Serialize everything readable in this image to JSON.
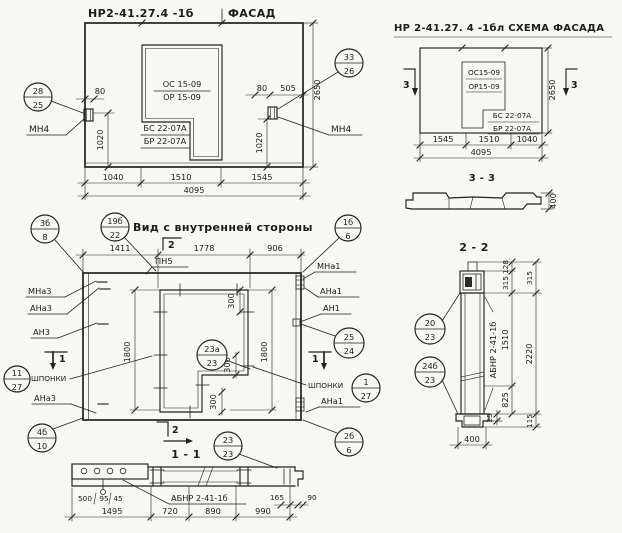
{
  "facade": {
    "code": "НР2-41.27.4 -1б",
    "title": "ФАСАД",
    "os": "ОС 15-09",
    "or": "ОР 15-09",
    "bs": "БС 22-07А",
    "br": "БР 22-07А",
    "mn4_left": "МН4",
    "mn4_right": "МН4",
    "co_left": {
      "top": "28",
      "bot": "25"
    },
    "co_right": {
      "top": "33",
      "bot": "26"
    },
    "d80l": "80",
    "d80r": "80",
    "d505": "505",
    "v1020l": "1020",
    "v1020r": "1020",
    "v2650": "2650",
    "b1": "1040",
    "b2": "1510",
    "b3": "1545",
    "btotal": "4095"
  },
  "schema": {
    "title": "НР 2-41.27. 4 -1бл СХЕМА ФАСАДА",
    "mark_left": "3",
    "mark_right": "3",
    "os": "ОС15-09",
    "or": "ОР15-09",
    "bs": "БС 22-07А",
    "br": "БР 22-07А",
    "v2650": "2650",
    "b1": "1545",
    "b2": "1510",
    "b3": "1040",
    "btotal": "4095"
  },
  "s33": {
    "title": "3 - 3",
    "d400": "400"
  },
  "view": {
    "title": "Вид с внутренней стороны",
    "pn5": "ПН5",
    "t1": "1411",
    "t2": "1778",
    "t3": "906",
    "mark_top": "2",
    "mark_bottom": "2",
    "mark_left": "1",
    "mark_right": "1",
    "v1800l": "1800",
    "v1800r": "1800",
    "d300a": "300",
    "d300b": "300",
    "d300c": "300",
    "mna3": "МНа3",
    "ana3": "АНа3",
    "an3": "АН3",
    "shponki_l": "ШПОНКИ",
    "ana3b": "АНа3",
    "mna1": "МНа1",
    "ana1": "АНа1",
    "an1": "АН1",
    "shponki_r": "ШПОНКИ",
    "ana1b": "АНа1",
    "co_title": {
      "top": "19б",
      "bot": "22"
    },
    "co_tl": {
      "top": "3б",
      "bot": "8"
    },
    "co_tr": {
      "top": "1б",
      "bot": "6"
    },
    "co_ml": {
      "top": "11",
      "bot": "27"
    },
    "co_mr": {
      "top": "25",
      "bot": "24"
    },
    "co_keys": {
      "top": "1",
      "bot": "27"
    },
    "co_bl": {
      "top": "4б",
      "bot": "10"
    },
    "co_br": {
      "top": "2б",
      "bot": "6"
    },
    "co_bc": {
      "top": "23",
      "bot": "23"
    },
    "co_win": {
      "top": "23а",
      "bot": "23"
    }
  },
  "s11": {
    "title": "1 - 1",
    "label": "АБНР 2-41-1б",
    "d500": "500",
    "d95": "95",
    "d45": "45",
    "d165": "165",
    "d90": "90",
    "b1": "1495",
    "b2": "720",
    "b3": "890",
    "b4": "990"
  },
  "s22": {
    "title": "2 - 2",
    "label": "АБНР 2-41-1б",
    "co1": {
      "top": "20",
      "bot": "23"
    },
    "co2": {
      "top": "24б",
      "bot": "23"
    },
    "d128": "128",
    "d315i": "315",
    "d315o": "315",
    "d1510": "1510",
    "d825": "825",
    "d2220": "2220",
    "d25": "25",
    "d115": "115",
    "d400": "400"
  }
}
